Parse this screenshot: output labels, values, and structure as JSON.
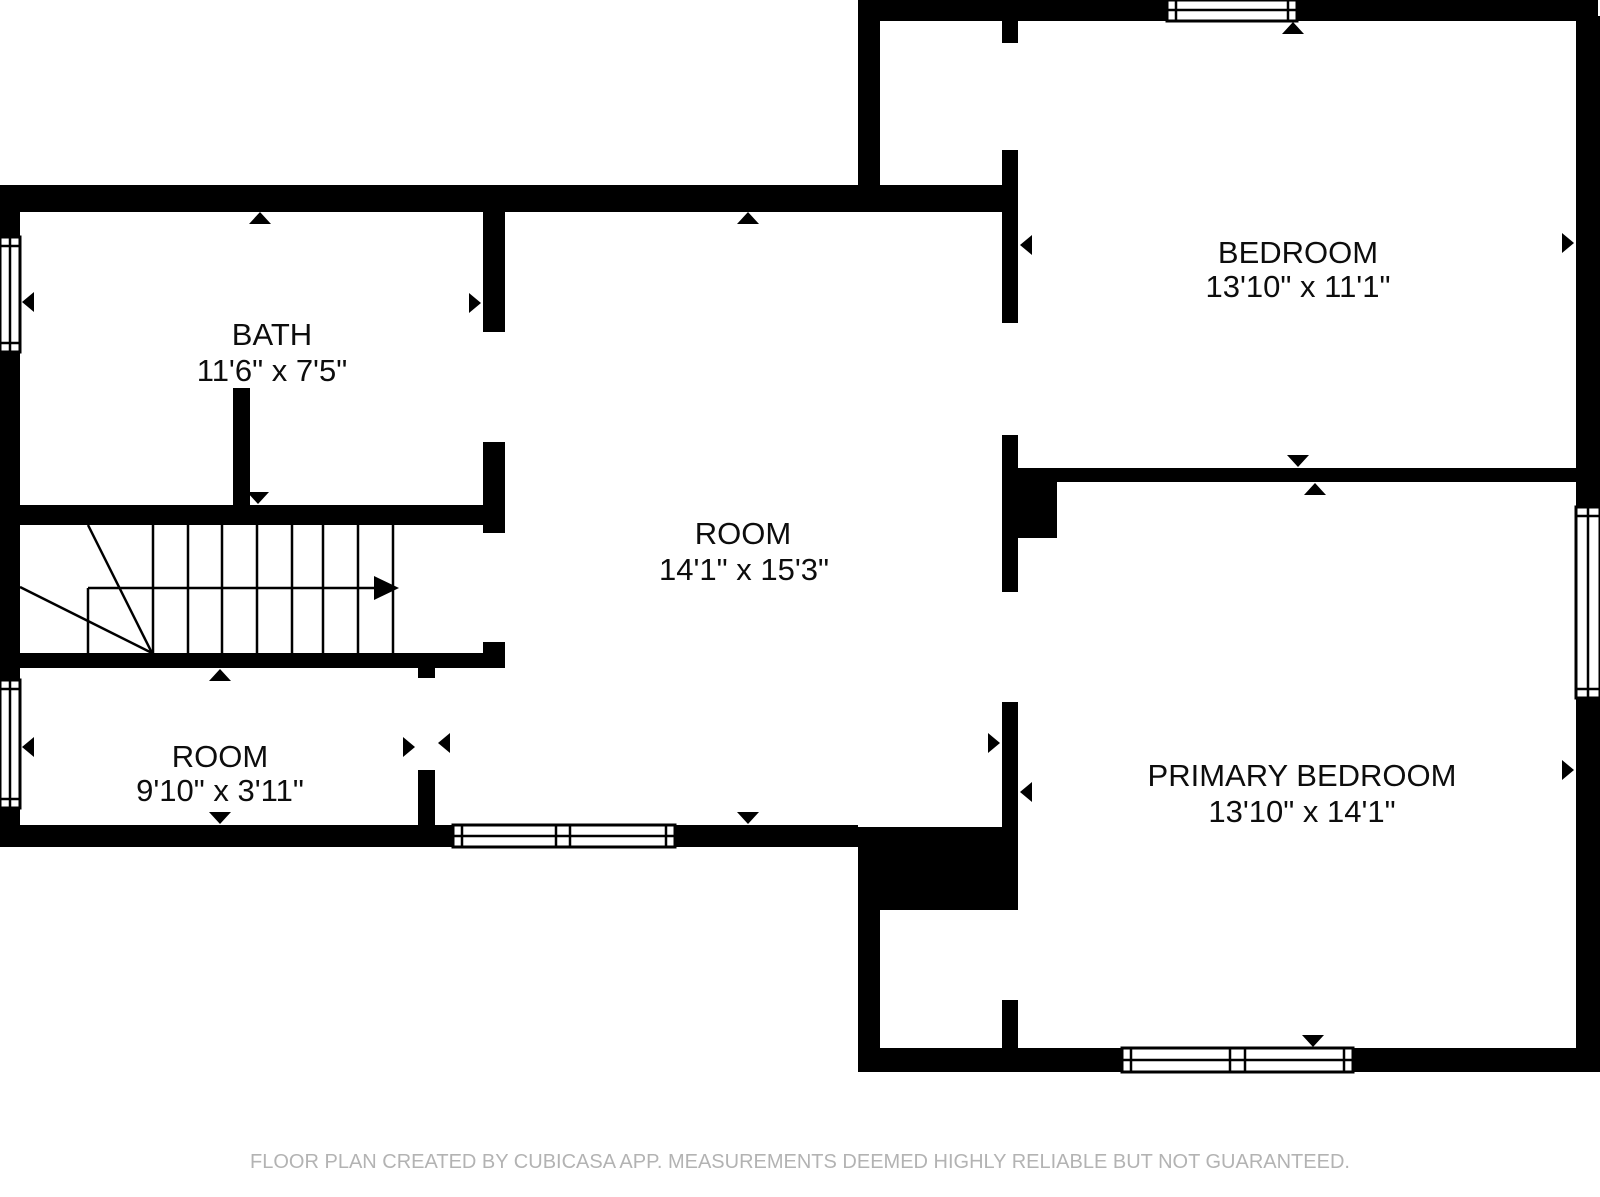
{
  "floor_plan": {
    "rooms": [
      {
        "name": "BATH",
        "dimensions": "11'6\" x 7'5\""
      },
      {
        "name": "ROOM",
        "dimensions": "14'1\" x 15'3\""
      },
      {
        "name": "BEDROOM",
        "dimensions": "13'10\" x 11'1\""
      },
      {
        "name": "ROOM",
        "dimensions": "9'10\" x 3'11\""
      },
      {
        "name": "PRIMARY BEDROOM",
        "dimensions": "13'10\" x 14'1\""
      }
    ],
    "stairs": {
      "direction_icon": "right-arrow"
    },
    "footer": "FLOOR PLAN CREATED BY CUBICASA APP. MEASUREMENTS DEEMED HIGHLY RELIABLE BUT NOT GUARANTEED.",
    "colors": {
      "wall": "#000000",
      "background": "#ffffff",
      "footer_text": "#b3b3b3"
    }
  }
}
